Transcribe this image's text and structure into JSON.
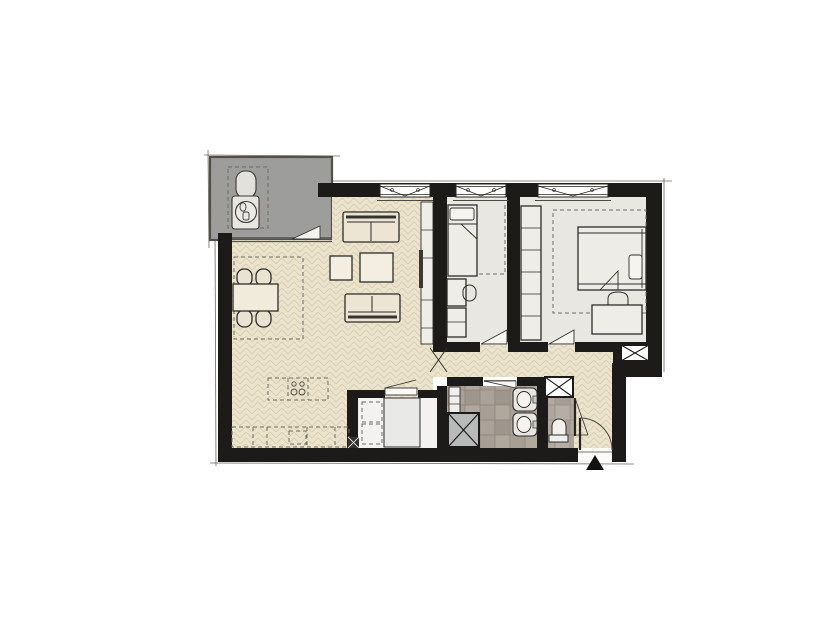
{
  "meta": {
    "kind": "architectural-floor-plan",
    "visible_text": "",
    "entrance_marker": "black triangle arrow at main entrance"
  },
  "colors": {
    "wall": "#1c1b19",
    "wood_floor": "#ece3cd",
    "wood_line": "#d9cfb4",
    "bedroom_floor": "#e9e7e1",
    "tile_base": "#a49c93",
    "tile_line": "#8f877e",
    "terrace": "#9d9d9b",
    "utility_floor": "#f3f2f0",
    "shaft_gray": "#b7bab8",
    "furniture_fill": "#efede7",
    "sofa_fill": "#ece5d3",
    "line": "#2e2c29",
    "marker": "#111111"
  },
  "plan": {
    "rooms": [
      {
        "id": "terrace",
        "kind": "terrace",
        "furniture": [
          "lounge-chair",
          "side-table",
          "dashed-zone"
        ]
      },
      {
        "id": "living-kitchen",
        "kind": "living-room-open-kitchen",
        "furniture": [
          "sofa-top",
          "sofa-bottom",
          "side-table",
          "coffee-table",
          "tv-cabinet",
          "tv",
          "dining-table",
          "dining-chairs-x4",
          "kitchen-island-cooktop-dashed",
          "kitchen-counter-dashed",
          "ceiling-zone-dashed"
        ]
      },
      {
        "id": "bedroom-1",
        "kind": "bedroom",
        "furniture": [
          "single-bed",
          "desk",
          "chair",
          "cabinet"
        ]
      },
      {
        "id": "bedroom-2",
        "kind": "bedroom",
        "furniture": [
          "double-bed",
          "wardrobe-column",
          "desk",
          "chair"
        ]
      },
      {
        "id": "corridor",
        "kind": "hallway",
        "furniture": []
      },
      {
        "id": "bathroom",
        "kind": "bathroom",
        "furniture": [
          "washbasin-1",
          "washbasin-2",
          "radiator",
          "shaft-crossed"
        ]
      },
      {
        "id": "wc",
        "kind": "toilet-room",
        "furniture": [
          "toilet"
        ]
      },
      {
        "id": "utility",
        "kind": "utility-room",
        "furniture": [
          "appliance",
          "appliance-position-dashed-1",
          "appliance-position-dashed-2",
          "mini-shaft"
        ]
      }
    ],
    "windows_top_wall": 3,
    "doors": [
      "terrace-door",
      "bedroom-1-door",
      "bedroom-2-door",
      "living-corridor-door",
      "bathroom-door",
      "wc-door",
      "utility-door",
      "entrance-door-arc"
    ],
    "shafts": [
      "bathroom-shaft",
      "wc-top-shaft",
      "right-wall-hatch",
      "utility-mini-shaft"
    ]
  }
}
